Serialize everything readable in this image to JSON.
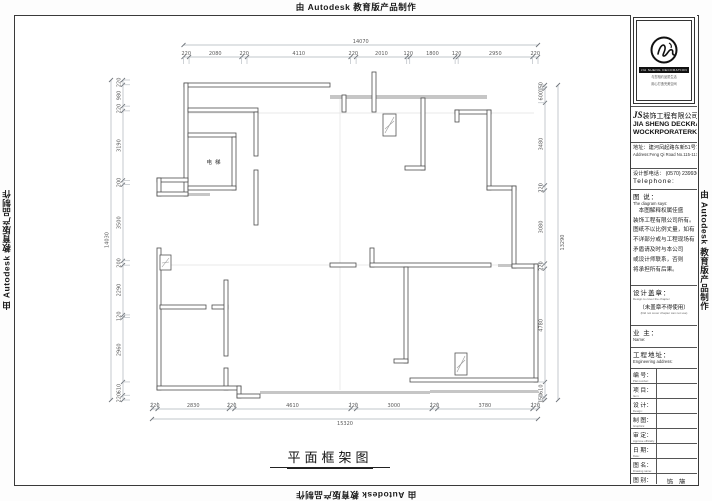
{
  "page": {
    "credit": "由 Autodesk 教育版产品制作"
  },
  "drawing": {
    "title": "平面框架图",
    "labels": {
      "elevator": "电梯"
    },
    "dimensions": {
      "top": {
        "overall": "14070",
        "segments": [
          220,
          2080,
          220,
          4110,
          220,
          2010,
          120,
          1800,
          120,
          2950,
          220
        ]
      },
      "bottom": {
        "overall": "15320",
        "segments": [
          220,
          2830,
          220,
          4610,
          220,
          3000,
          220,
          3780,
          220
        ]
      },
      "left": {
        "overall": "14030",
        "segments": [
          220,
          980,
          220,
          3190,
          200,
          3500,
          200,
          2290,
          120,
          2960,
          610,
          220
        ]
      },
      "right": {
        "overall": "13290",
        "segments": [
          150,
          600,
          3480,
          220,
          3080,
          220,
          4780,
          610,
          150
        ]
      }
    }
  },
  "title_block": {
    "logo": {
      "caption": "JIA SHENG DECORATION",
      "slogan1": "与您相约品质生活",
      "slogan2": "用心打造完美空间"
    },
    "company_cn_prefix": "JS",
    "company_cn": "装饰工程有限公司",
    "company_en1": "JIA SHENG DECKRATE",
    "company_en2": "WOCKRPORATERKS",
    "address_cn": "地址：建河凤起路东新51号7号",
    "address_en": "Address:Feng Qi Road No.115-117",
    "phone_cn": "设计部电话： (0570) 2399369",
    "phone_en": "Telephone:",
    "notes_title_cn": "图 说：",
    "notes_title_en": "The diagram says:",
    "notes_lines": [
      "　本图解释权属佳盛",
      "装饰工程有限公司所有。",
      "图纸不以比例丈量，如有",
      "不详部分或与工程现场有",
      "矛盾请及时与本公司",
      "或设计师联系，否则",
      "将承担所有后果。"
    ],
    "seal_cn": "设计盖章：",
    "seal_en": "Design to cover the chapter",
    "seal_warn_cn": "（未盖章不得使用）",
    "seal_warn_en": "(Did not cover chapter can not use)",
    "owner_cn": "业  主：",
    "owner_en": "Name:",
    "site_cn": "工程地址：",
    "site_en": "Engineering address:",
    "rows": [
      {
        "cn": "编 号：",
        "en": "Plat number:",
        "value": ""
      },
      {
        "cn": "项 目：",
        "en": "Item:",
        "value": ""
      },
      {
        "cn": "设 计：",
        "en": "Design:",
        "value": ""
      },
      {
        "cn": "制 图：",
        "en": "Graphics:",
        "value": ""
      },
      {
        "cn": "审 定：",
        "en": "Approve officially:",
        "value": ""
      },
      {
        "cn": "日 期：",
        "en": "Date:",
        "value": ""
      },
      {
        "cn": "图 名：",
        "en": "Drawing name:",
        "value": ""
      },
      {
        "cn": "图 别：",
        "en": "Diagram sort:",
        "value": "饰 施"
      },
      {
        "cn": "图 号：",
        "en": "Diagram number:",
        "value": "PM-01"
      }
    ]
  }
}
